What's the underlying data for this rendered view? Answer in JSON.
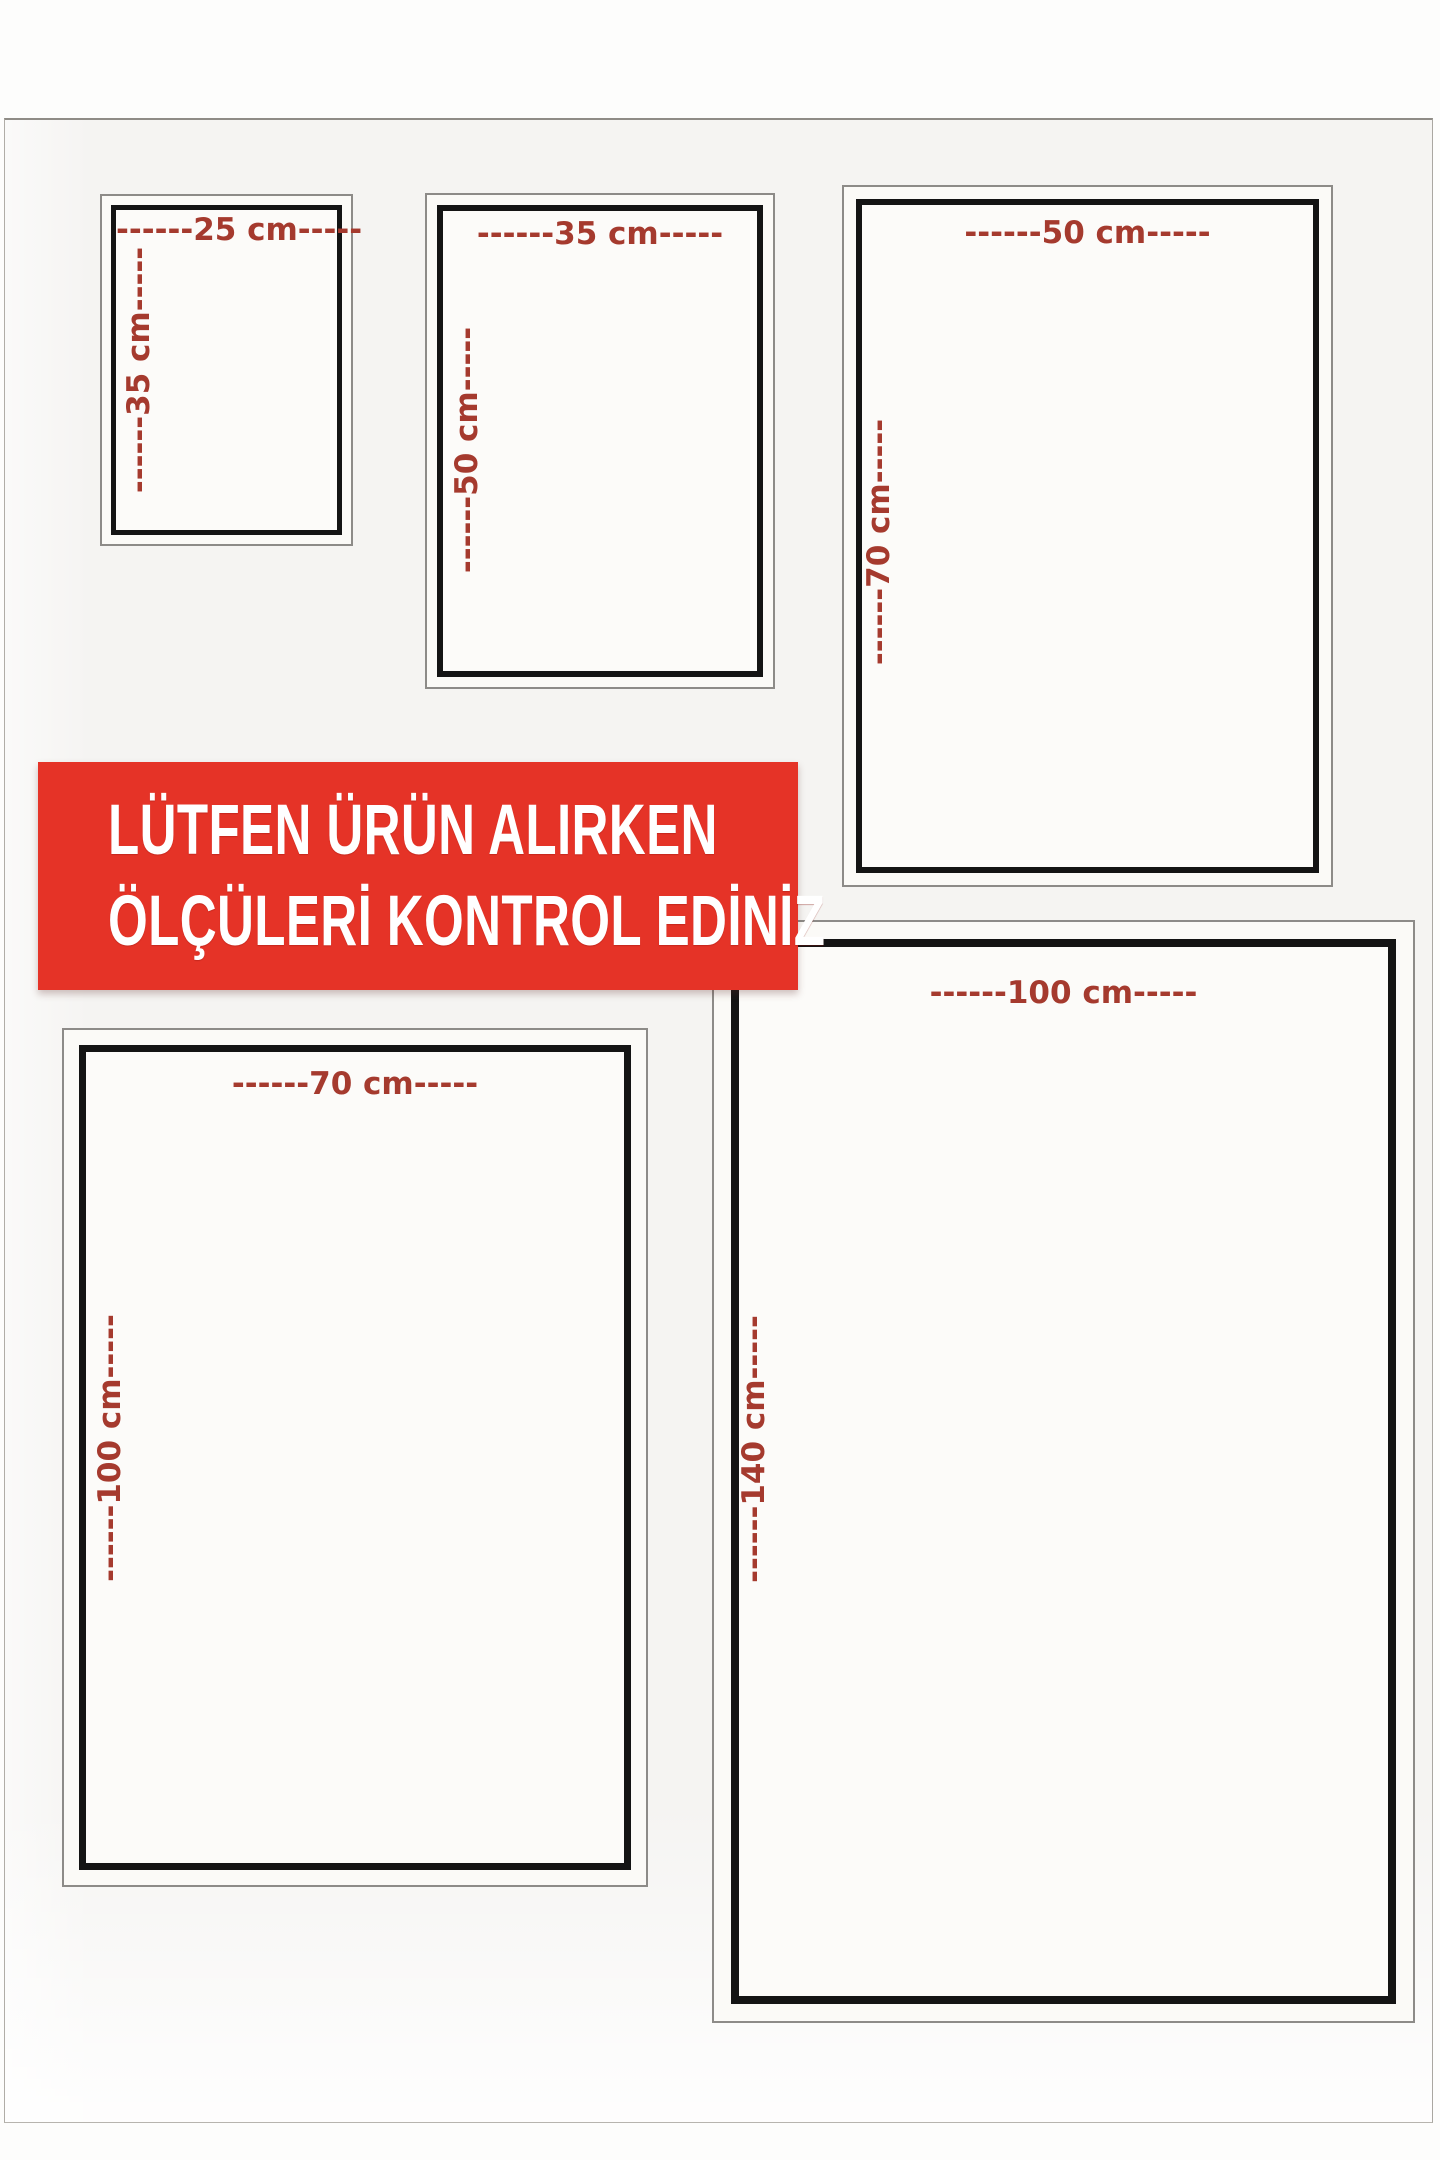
{
  "banner": {
    "line1": "LÜTFEN ÜRÜN ALIRKEN",
    "line2": "ÖLÇÜLERİ KONTROL EDİNİZ"
  },
  "size_boxes": [
    {
      "name": "25x35 cm",
      "width_cm": 25,
      "height_cm": 35,
      "width_label": "------25 cm-----",
      "height_label": "------35 cm-----"
    },
    {
      "name": "35x50 cm",
      "width_cm": 35,
      "height_cm": 50,
      "width_label": "------35 cm-----",
      "height_label": "------50 cm-----"
    },
    {
      "name": "50x70 cm",
      "width_cm": 50,
      "height_cm": 70,
      "width_label": "------50 cm-----",
      "height_label": "------70 cm-----"
    },
    {
      "name": "70x100 cm",
      "width_cm": 70,
      "height_cm": 100,
      "width_label": "------70 cm-----",
      "height_label": "------100 cm-----"
    },
    {
      "name": "100x140 cm",
      "width_cm": 100,
      "height_cm": 140,
      "width_label": "------100 cm-----",
      "height_label": "------140 cm-----"
    }
  ],
  "colors": {
    "banner_bg": "#e53327",
    "banner_text": "#ffffff",
    "dimension_text": "#a53a2e",
    "page_band_bg": "#f5f4f2",
    "box_border_black": "#141414",
    "box_border_gray": "#8d8b88"
  }
}
